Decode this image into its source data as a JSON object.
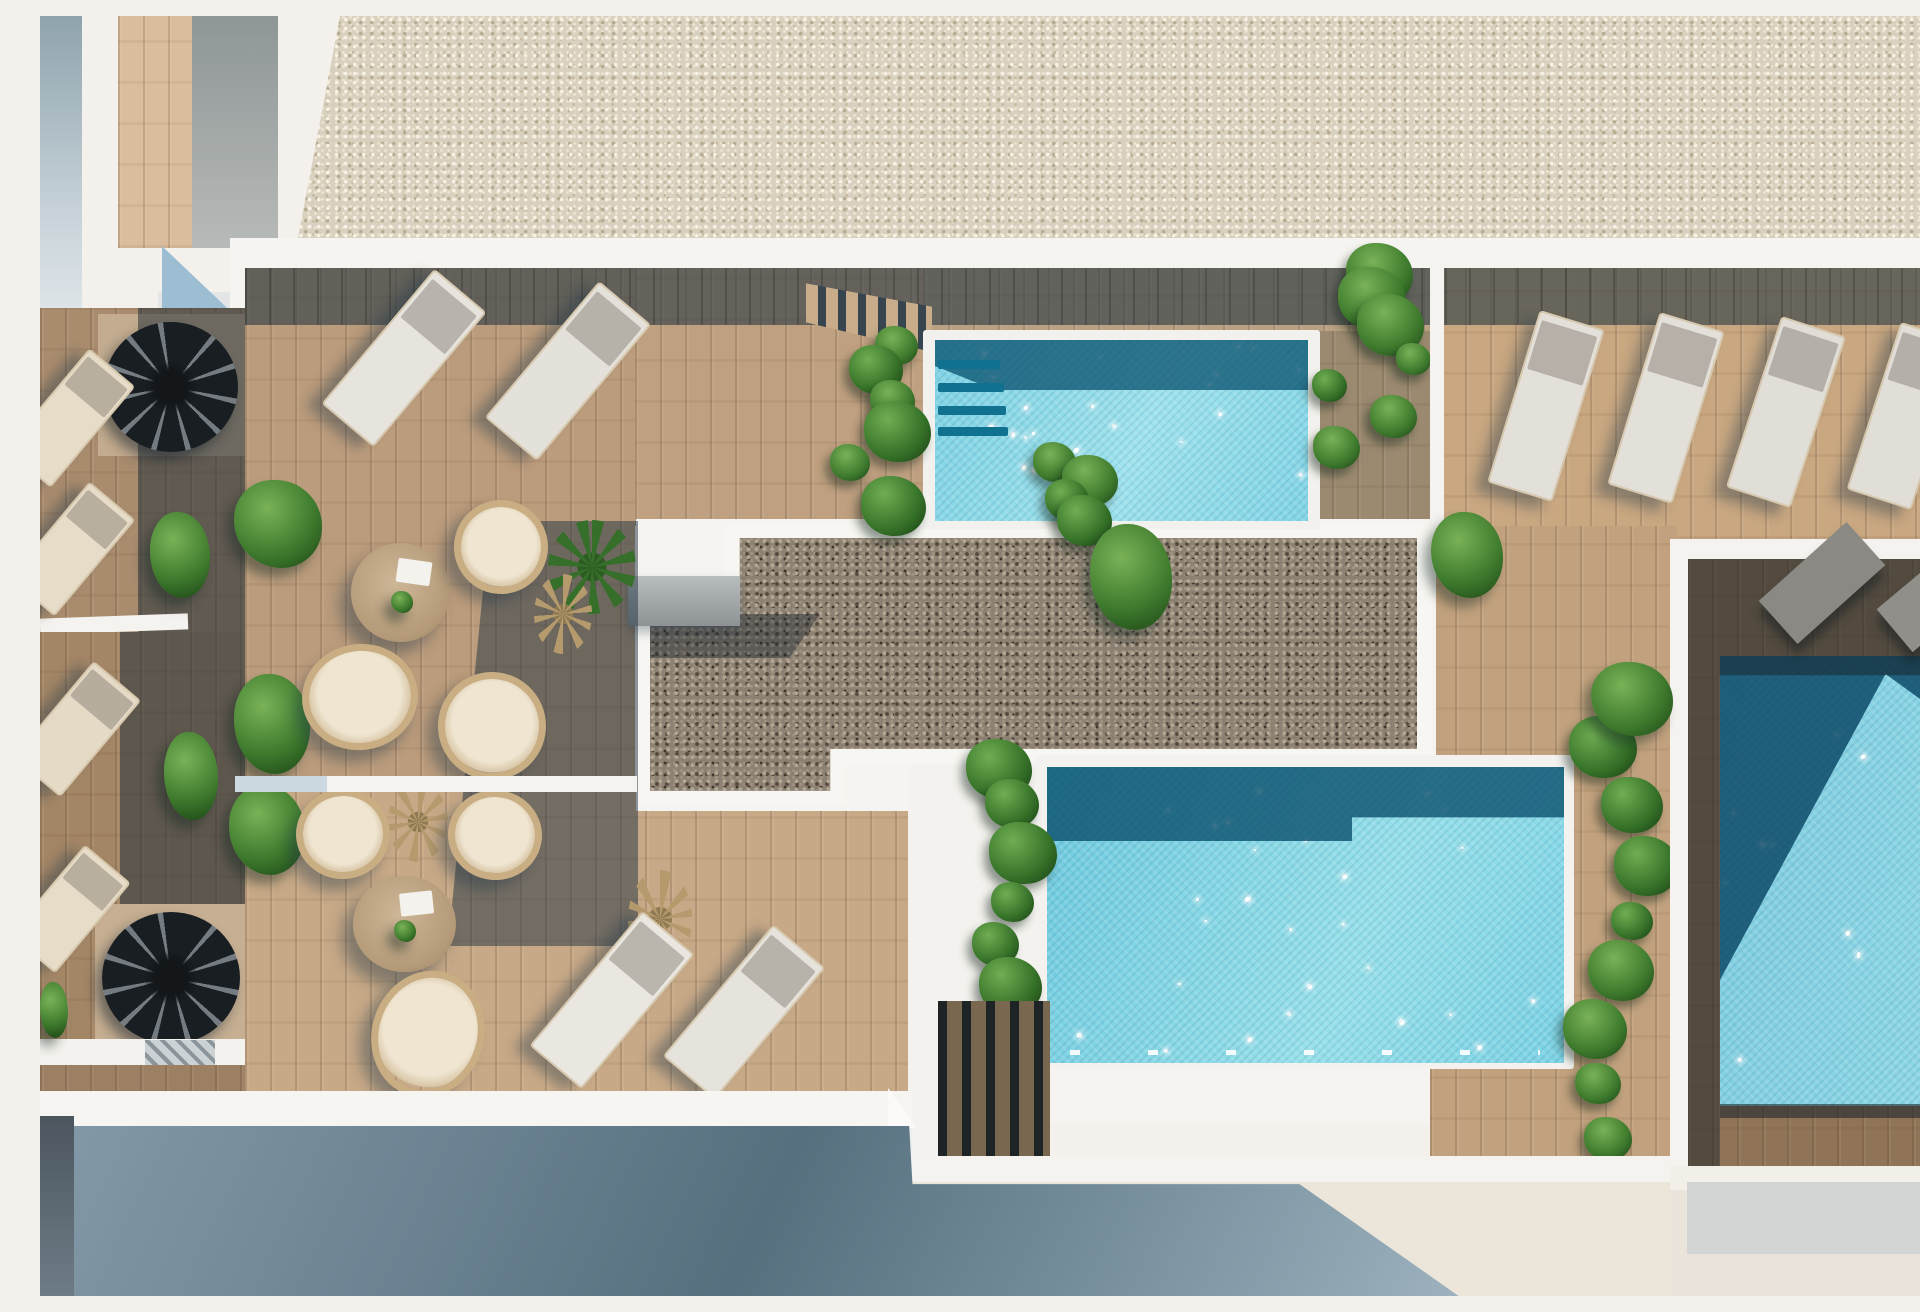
{
  "meta": {
    "scene": "top-down architectural 3D render of a rooftop terrace with three swimming pools, wooden decks, sun loungers, rattan seating and planters",
    "width": 1920,
    "height": 1280
  },
  "palette": {
    "white_wall": "#f5f3ef",
    "roof_gravel": "#d9d1c0",
    "deck_wood": "#c0a07e",
    "deck_shadow": "#41525f",
    "pool_aqua": "#8fd9e8",
    "pool_dark": "#135e82",
    "bed_gravel": "#8c8173",
    "plant_green": "#3e7a2d",
    "ground_shadow": "#5c7583"
  },
  "items": [
    {
      "n": "sky-white-base",
      "x": 0,
      "y": 0,
      "w": 1920,
      "h": 1280,
      "c": "#f4f1ec"
    },
    {
      "n": "roof-gravel-strip",
      "cls": "gravelA",
      "x": 258,
      "y": 0,
      "w": 1635,
      "h": 222,
      "cp": "polygon(42px 0,100% 0,100% 100%,0 100%)"
    },
    {
      "n": "building-strip-left",
      "x": 0,
      "y": 0,
      "w": 42,
      "h": 292,
      "bg": "linear-gradient(180deg,#8fa3ae,#c9d4da 70%,#dde4e8)"
    },
    {
      "n": "wood-panel-topleft",
      "cls": "wood",
      "x": 78,
      "y": 0,
      "w": 74,
      "h": 232,
      "c": "#d9bd9d"
    },
    {
      "n": "gray-panel-topleft",
      "x": 152,
      "y": 0,
      "w": 86,
      "h": 232,
      "bg": "linear-gradient(180deg,#8e9696,#b7bab8)"
    },
    {
      "n": "white-slab-topleft",
      "x": 118,
      "y": 276,
      "w": 88,
      "h": 34,
      "c": "#e3e5e6"
    },
    {
      "n": "shadow-triangle-topleft",
      "x": 122,
      "y": 230,
      "w": 84,
      "h": 80,
      "c": "#9dbdd3",
      "cp": "polygon(0 0,100% 100%,0 100%)"
    },
    {
      "n": "platform-white-base",
      "x": 190,
      "y": 222,
      "w": 1730,
      "h": 886,
      "c": "#f6f4f0"
    },
    {
      "n": "left-terrace-floor-upper",
      "cls": "wood",
      "x": 0,
      "y": 292,
      "w": 205,
      "h": 330,
      "c": "#a98c6e"
    },
    {
      "n": "spiral-stair-floor-upper",
      "x": 58,
      "y": 298,
      "w": 148,
      "h": 142,
      "c": "#c3ac8f"
    },
    {
      "n": "left-terrace-shadow-upper",
      "x": 98,
      "y": 292,
      "w": 107,
      "h": 330,
      "c": "rgba(26,40,52,.5)"
    },
    {
      "n": "spiral-staircase-upper",
      "cls": "spiral",
      "x": 64,
      "y": 306,
      "w": 134,
      "h": 130
    },
    {
      "n": "left-wall-band-mid",
      "x": 0,
      "y": 600,
      "w": 148,
      "h": 16,
      "c": "#f5f3ef",
      "tr": "rotate(-2deg)"
    },
    {
      "n": "left-terrace-floor-lower",
      "cls": "wood",
      "x": 0,
      "y": 616,
      "w": 205,
      "h": 410,
      "c": "#a38666"
    },
    {
      "n": "left-terrace-shadow-lower",
      "x": 80,
      "y": 616,
      "w": 125,
      "h": 410,
      "c": "rgba(26,40,52,.5)"
    },
    {
      "n": "spiral-stair-floor-lower",
      "x": 55,
      "y": 888,
      "w": 150,
      "h": 140,
      "c": "#c6af92"
    },
    {
      "n": "spiral-staircase-lower",
      "cls": "spiral",
      "x": 62,
      "y": 896,
      "w": 138,
      "h": 132
    },
    {
      "n": "left-wall-band-lower",
      "x": 0,
      "y": 1023,
      "w": 205,
      "h": 26,
      "c": "#f4f2ee"
    },
    {
      "n": "hatched-slab",
      "cls": "slabH",
      "x": 105,
      "y": 1024,
      "w": 70,
      "h": 27
    },
    {
      "n": "left-terrace-floor-bottom",
      "cls": "wood",
      "x": 0,
      "y": 1049,
      "w": 205,
      "h": 28,
      "c": "#9c8063"
    },
    {
      "n": "grass-patch-left",
      "cls": "bush",
      "x": 0,
      "y": 966,
      "w": 28,
      "h": 56
    },
    {
      "n": "lounger-left-1",
      "cls": "lounger",
      "x": 0,
      "y": 336,
      "w": 56,
      "h": 128,
      "c": "#e7dcc8",
      "tr": "rotate(40deg)"
    },
    {
      "n": "lounger-left-2",
      "cls": "lounger",
      "x": 2,
      "y": 470,
      "w": 56,
      "h": 122,
      "c": "#e7dcc8",
      "tr": "rotate(40deg)"
    },
    {
      "n": "lounger-left-3",
      "cls": "lounger",
      "x": 6,
      "y": 650,
      "w": 58,
      "h": 122,
      "c": "#e5dac6",
      "tr": "rotate(40deg)"
    },
    {
      "n": "lounger-left-4",
      "cls": "lounger",
      "x": 0,
      "y": 834,
      "w": 56,
      "h": 114,
      "c": "#e7dcc8",
      "tr": "rotate(40deg)"
    },
    {
      "n": "bush-left-terrace-1",
      "cls": "bush",
      "x": 110,
      "y": 496,
      "w": 60,
      "h": 86
    },
    {
      "n": "bush-left-terrace-2",
      "cls": "bush",
      "x": 124,
      "y": 716,
      "w": 54,
      "h": 88
    },
    {
      "n": "side-table-left-edge",
      "x": 0,
      "y": 1082,
      "w": 26,
      "h": 26,
      "c": "#d8d8d6",
      "br": "50%"
    },
    {
      "n": "deck-left-upper",
      "cls": "wood",
      "x": 205,
      "y": 252,
      "w": 390,
      "h": 523,
      "c": "#bb9c7c"
    },
    {
      "n": "deck-left-lower",
      "cls": "wood",
      "x": 205,
      "y": 775,
      "w": 665,
      "h": 315,
      "c": "#c7a987"
    },
    {
      "n": "deck-top-middle",
      "cls": "wood",
      "x": 595,
      "y": 252,
      "w": 295,
      "h": 258,
      "c": "#bfa080"
    },
    {
      "n": "deck-pool1-top",
      "cls": "wood",
      "x": 883,
      "y": 252,
      "w": 517,
      "h": 70,
      "c": "#b9a183"
    },
    {
      "n": "deck-pool1-right",
      "cls": "wood",
      "x": 1267,
      "y": 315,
      "w": 133,
      "h": 198,
      "c": "#9b8a70"
    },
    {
      "n": "deck-right-upper",
      "cls": "wood",
      "x": 1400,
      "y": 252,
      "w": 520,
      "h": 271,
      "c": "#c8a781"
    },
    {
      "n": "deck-mid-right",
      "cls": "wood",
      "x": 1390,
      "y": 510,
      "w": 247,
      "h": 635,
      "c": "#c2a27e"
    },
    {
      "n": "deck-pool3-surround",
      "cls": "wood",
      "x": 1647,
      "y": 543,
      "w": 273,
      "h": 612,
      "c": "#8f7457"
    },
    {
      "n": "top-shadow-band",
      "cls": "bandlines",
      "x": 205,
      "y": 252,
      "w": 1715,
      "h": 57,
      "c": "rgba(40,56,67,.6)"
    },
    {
      "n": "stair-treads-top",
      "cls": "treads",
      "x": 766,
      "y": 258,
      "w": 126,
      "h": 78,
      "cp": "polygon(0 12%,100% 42%,100% 100%,0 62%)"
    },
    {
      "n": "stair-shadow-wedge",
      "x": 766,
      "y": 300,
      "w": 132,
      "h": 88,
      "c": "rgba(30,45,56,.55),",
      "cp": "polygon(0 18%,100% 2%,52% 100%,0 100%)"
    },
    {
      "n": "plaza-white",
      "x": 596,
      "y": 503,
      "w": 800,
      "h": 292,
      "c": "#f6f4f0"
    },
    {
      "n": "plaza-white-south",
      "x": 868,
      "y": 740,
      "w": 142,
      "h": 412,
      "c": "#f4f2ee"
    },
    {
      "n": "gravel-bed-border",
      "x": 596,
      "y": 508,
      "w": 800,
      "h": 286,
      "c": "#f7f6f2",
      "cp": "polygon(0 30%,11.3% 30%,11.3% 0,99.5% 0,99.5% 84%,26.3% 84%,26.3% 98.6%,0 98.6%)"
    },
    {
      "n": "gravel-bed",
      "cls": "gravelB",
      "x": 610,
      "y": 522,
      "w": 767,
      "h": 258,
      "cp": "polygon(0 33.3%,11.7% 33.3%,11.7% 0,100% 0,100% 81.8%,23.5% 81.8%,23.5% 98%,0 98%)"
    },
    {
      "n": "gravel-shadow-edge",
      "x": 610,
      "y": 598,
      "w": 170,
      "h": 44,
      "c": "rgba(22,32,42,.4)",
      "cp": "polygon(0 0,100% 0,82% 100%,0 100%)"
    },
    {
      "n": "concrete-slab",
      "x": 588,
      "y": 560,
      "w": 112,
      "h": 50,
      "bg": "linear-gradient(180deg,#b9bdbe,#8d9395)",
      "bs": "0 6px 10px rgba(40,60,75,.35)"
    },
    {
      "n": "pool1-coping",
      "x": 883,
      "y": 314,
      "w": 397,
      "h": 199,
      "c": "#f2f1ed",
      "br": "3px"
    },
    {
      "n": "pool1-water",
      "cls": "water",
      "x": 895,
      "y": 324,
      "w": 373,
      "h": 181,
      "bg": "linear-gradient(115deg,#7ed2e4,#9ee2ec 55%,#83d5e6)",
      "sp": 22
    },
    {
      "n": "pool1-shadow-water",
      "x": 895,
      "y": 324,
      "w": 373,
      "h": 50,
      "c": "rgba(12,84,114,.78)",
      "cp": "polygon(0 0,100% 0,100% 100%,16% 100%,0 52%)"
    },
    {
      "n": "pool1-step-1",
      "x": 898,
      "y": 344,
      "w": 62,
      "h": 9,
      "c": "#117190",
      "br": "2px"
    },
    {
      "n": "pool1-step-2",
      "x": 898,
      "y": 367,
      "w": 66,
      "h": 9,
      "c": "#117190",
      "br": "2px"
    },
    {
      "n": "pool1-step-3",
      "x": 898,
      "y": 390,
      "w": 68,
      "h": 9,
      "c": "#117190",
      "br": "2px"
    },
    {
      "n": "pool1-step-4",
      "x": 898,
      "y": 411,
      "w": 70,
      "h": 9,
      "c": "#117190",
      "br": "2px"
    },
    {
      "n": "planter-pool1-left",
      "cls": "leafcol",
      "x": 790,
      "y": 316,
      "w": 96,
      "h": 192,
      "k": 6
    },
    {
      "n": "planter-pool1-right",
      "cls": "leafcol",
      "x": 1266,
      "y": 248,
      "w": 124,
      "h": 210,
      "k": 7
    },
    {
      "n": "white-wall-pool1-right",
      "x": 1390,
      "y": 248,
      "w": 14,
      "h": 264,
      "c": "#f5f3ef"
    },
    {
      "n": "plant-cluster-mid",
      "cls": "leafcol",
      "x": 980,
      "y": 450,
      "w": 108,
      "h": 64,
      "k": 4
    },
    {
      "n": "bush-gravel-corner",
      "cls": "bush",
      "x": 1050,
      "y": 508,
      "w": 82,
      "h": 106
    },
    {
      "n": "pool2-coping",
      "x": 995,
      "y": 739,
      "w": 539,
      "h": 314,
      "c": "#f3f2ee",
      "br": "3px"
    },
    {
      "n": "pool2-water",
      "cls": "water",
      "x": 1007,
      "y": 751,
      "w": 517,
      "h": 296,
      "bg": "linear-gradient(115deg,#6ecadf,#97e0ea 60%,#7dd3e5)",
      "sp": 26
    },
    {
      "n": "pool2-shadow-water",
      "x": 1007,
      "y": 751,
      "w": 517,
      "h": 74,
      "c": "rgba(10,80,110,.8)",
      "cp": "polygon(0 0,100% 0,100% 68%,59% 68%,59% 100%,0 100%)"
    },
    {
      "n": "pool2-lane-dashes",
      "x": 1030,
      "y": 1034,
      "w": 470,
      "h": 5,
      "bg": "repeating-linear-gradient(90deg,rgba(255,255,255,.9) 0 10px,transparent 10px 78px)"
    },
    {
      "n": "planter-pool2-left",
      "cls": "leafcol",
      "x": 932,
      "y": 736,
      "w": 80,
      "h": 272,
      "k": 6
    },
    {
      "n": "deck-steps-block",
      "cls": "stepsV",
      "x": 898,
      "y": 985,
      "w": 112,
      "h": 158
    },
    {
      "n": "planter-pool2-right",
      "cls": "leafcol",
      "x": 1520,
      "y": 718,
      "w": 116,
      "h": 446,
      "k": 8
    },
    {
      "n": "pool3-water",
      "cls": "water",
      "x": 1680,
      "y": 640,
      "w": 240,
      "h": 450,
      "bg": "linear-gradient(100deg,#7fcde0,#8fd8e6)",
      "sp": 14
    },
    {
      "n": "pool3-shadow-water",
      "x": 1680,
      "y": 640,
      "w": 240,
      "h": 450,
      "c": "rgba(9,70,100,.82)",
      "cp": "polygon(0 0,100% 0,100% 16%,69% 4%,0 72%)"
    },
    {
      "n": "pool3-groove",
      "x": 1680,
      "y": 1088,
      "w": 240,
      "h": 14,
      "c": "rgba(30,38,44,.6)"
    },
    {
      "n": "pool3-deck-shadow",
      "x": 1647,
      "y": 543,
      "w": 273,
      "h": 612,
      "c": "rgba(24,33,40,.5)",
      "cp": "polygon(0 0,100% 0,100% 19%,12% 19%,12% 100%,0 100%)"
    },
    {
      "n": "white-wall-pool3-left",
      "x": 1630,
      "y": 523,
      "w": 18,
      "h": 640,
      "c": "#f5f3ef"
    },
    {
      "n": "white-wall-pool3-top",
      "x": 1630,
      "y": 523,
      "w": 290,
      "h": 20,
      "c": "#f5f3ef"
    },
    {
      "n": "gray-lounger-1",
      "x": 1723,
      "y": 538,
      "w": 118,
      "h": 58,
      "c": "#8b8984",
      "tr": "rotate(-42deg)",
      "bs": "-8px 8px 10px rgba(20,28,34,.5)"
    },
    {
      "n": "gray-lounger-2",
      "x": 1842,
      "y": 552,
      "w": 108,
      "h": 56,
      "c": "#918f8a",
      "tr": "rotate(-40deg)",
      "bs": "-8px 8px 10px rgba(20,28,34,.5)"
    },
    {
      "n": "bush-right-deck-1",
      "cls": "bush",
      "x": 1391,
      "y": 496,
      "w": 72,
      "h": 86
    },
    {
      "n": "bush-right-deck-2",
      "cls": "bush",
      "x": 1551,
      "y": 646,
      "w": 82,
      "h": 74
    },
    {
      "n": "deck-shadow-diagonal",
      "x": 408,
      "y": 505,
      "w": 190,
      "h": 425,
      "c": "rgba(31,50,64,.5)",
      "cp": "polygon(22% 0,100% 0,100% 100%,0 100%)"
    },
    {
      "n": "lounger-deck-1",
      "cls": "lounger",
      "x": 330,
      "y": 254,
      "w": 64,
      "h": 172,
      "c": "#e7e4de",
      "tr": "rotate(40deg)"
    },
    {
      "n": "lounger-deck-2",
      "cls": "lounger",
      "x": 494,
      "y": 266,
      "w": 64,
      "h": 174,
      "c": "#e4e1da",
      "tr": "rotate(40deg)"
    },
    {
      "n": "bush-terrace-1",
      "cls": "bush",
      "x": 194,
      "y": 464,
      "w": 88,
      "h": 88
    },
    {
      "n": "bush-terrace-2",
      "cls": "bush",
      "x": 194,
      "y": 658,
      "w": 76,
      "h": 100
    },
    {
      "n": "bush-terrace-3",
      "cls": "bush",
      "x": 189,
      "y": 769,
      "w": 76,
      "h": 90
    },
    {
      "n": "palm-yucca",
      "cls": "palmg",
      "x": 508,
      "y": 504,
      "w": 88,
      "h": 94
    },
    {
      "n": "dry-palm-1",
      "cls": "palmd",
      "x": 494,
      "y": 558,
      "w": 58,
      "h": 80
    },
    {
      "n": "dry-palm-2",
      "cls": "palmd",
      "x": 348,
      "y": 766,
      "w": 60,
      "h": 80
    },
    {
      "n": "dry-palm-3",
      "cls": "palmd",
      "x": 588,
      "y": 854,
      "w": 64,
      "h": 98
    },
    {
      "n": "round-table-upper",
      "cls": "tableR",
      "x": 311,
      "y": 527,
      "w": 99,
      "h": 99
    },
    {
      "n": "book-on-table-upper",
      "x": 357,
      "y": 544,
      "w": 34,
      "h": 24,
      "c": "#f4f2ec",
      "tr": "rotate(8deg)",
      "br": "2px"
    },
    {
      "n": "plant-pot-upper",
      "cls": "bush",
      "x": 351,
      "y": 575,
      "w": 22,
      "h": 22
    },
    {
      "n": "armchair-upper-east",
      "cls": "rattan",
      "x": 414,
      "y": 484,
      "w": 94,
      "h": 94,
      "tr": "rotate(14deg)"
    },
    {
      "n": "armchair-upper-sw",
      "cls": "rattan",
      "x": 262,
      "y": 628,
      "w": 116,
      "h": 106,
      "tr": "rotate(-8deg)"
    },
    {
      "n": "armchair-upper-se",
      "cls": "rattan",
      "x": 398,
      "y": 656,
      "w": 108,
      "h": 108,
      "tr": "rotate(10deg)"
    },
    {
      "n": "armchair-lower-nw",
      "cls": "rattan",
      "x": 256,
      "y": 773,
      "w": 94,
      "h": 90,
      "tr": "rotate(-4deg)"
    },
    {
      "n": "armchair-lower-ne",
      "cls": "rattan",
      "x": 408,
      "y": 774,
      "w": 94,
      "h": 90,
      "tr": "rotate(6deg)"
    },
    {
      "n": "round-table-lower",
      "cls": "tableR",
      "x": 313,
      "y": 860,
      "w": 103,
      "h": 96
    },
    {
      "n": "book-on-table-lower",
      "x": 360,
      "y": 876,
      "w": 33,
      "h": 23,
      "c": "#f4f2ec",
      "tr": "rotate(-6deg)",
      "br": "2px"
    },
    {
      "n": "plant-pot-lower",
      "cls": "bush",
      "x": 354,
      "y": 904,
      "w": 22,
      "h": 22
    },
    {
      "n": "armchair-lower-south",
      "cls": "rattan",
      "x": 332,
      "y": 954,
      "w": 112,
      "h": 128,
      "tr": "rotate(18deg)"
    },
    {
      "n": "lounger-bottom-1",
      "cls": "lounger",
      "x": 538,
      "y": 896,
      "w": 64,
      "h": 172,
      "c": "#eae7e1",
      "tr": "rotate(40deg)"
    },
    {
      "n": "lounger-bottom-2",
      "cls": "lounger",
      "x": 670,
      "y": 910,
      "w": 64,
      "h": 168,
      "c": "#e6e3dc",
      "tr": "rotate(40deg)"
    },
    {
      "n": "lounger-row-1",
      "cls": "lounger",
      "x": 1472,
      "y": 300,
      "w": 64,
      "h": 176,
      "c": "#e3dfd9",
      "tr": "rotate(17deg)"
    },
    {
      "n": "lounger-row-2",
      "cls": "lounger",
      "x": 1592,
      "y": 302,
      "w": 64,
      "h": 176,
      "c": "#e3dfd9",
      "tr": "rotate(17deg)"
    },
    {
      "n": "lounger-row-3",
      "cls": "lounger",
      "x": 1712,
      "y": 306,
      "w": 64,
      "h": 176,
      "c": "#e1ddd7",
      "tr": "rotate(18deg)"
    },
    {
      "n": "lounger-row-4",
      "cls": "lounger",
      "x": 1832,
      "y": 312,
      "w": 64,
      "h": 172,
      "c": "#e1ddd7",
      "tr": "rotate(18deg)"
    },
    {
      "n": "wall-band-terrace-divider",
      "x": 195,
      "y": 760,
      "w": 402,
      "h": 16,
      "c": "#f5f3ef"
    },
    {
      "n": "wall-band-divider-shaded",
      "x": 195,
      "y": 760,
      "w": 92,
      "h": 16,
      "c": "#cdd9e1"
    },
    {
      "n": "ground-left",
      "x": 0,
      "y": 1108,
      "w": 872,
      "h": 172,
      "c": "#eef0ef"
    },
    {
      "n": "ground-mid",
      "x": 870,
      "y": 1164,
      "w": 760,
      "h": 116,
      "c": "#ebe5da"
    },
    {
      "n": "ground-right",
      "x": 1630,
      "y": 1172,
      "w": 290,
      "h": 108,
      "c": "#eae4da"
    },
    {
      "n": "wall-band-bottom-left",
      "x": 0,
      "y": 1075,
      "w": 872,
      "h": 36,
      "c": "#f7f5f1"
    },
    {
      "n": "wall-band-bottom-mid",
      "x": 870,
      "y": 1140,
      "w": 762,
      "h": 26,
      "c": "#f5f3ef"
    },
    {
      "n": "wall-band-bottom-right",
      "x": 1630,
      "y": 1150,
      "w": 290,
      "h": 24,
      "c": "#f2efe9"
    },
    {
      "n": "white-notch-triangle",
      "x": 848,
      "y": 1072,
      "w": 28,
      "h": 40,
      "c": "#fbfaf8",
      "cp": "polygon(0 0,100% 100%,0 100%)"
    },
    {
      "n": "ground-shadow-main",
      "x": 0,
      "y": 1085,
      "w": 1640,
      "h": 195,
      "bg": "linear-gradient(115deg,#859aa9,#56707f 45%,#8ba2af 78%,#b6c8d1)",
      "cp": "polygon(0 12.8%,53% 12.8%,53.2% 42.6%,76.8% 42.6%,86.5% 100%,0 100%)"
    },
    {
      "n": "ground-shadow-left-strip",
      "x": 0,
      "y": 1100,
      "w": 34,
      "h": 180,
      "bg": "linear-gradient(180deg,#4b555e,#6e7c87)"
    },
    {
      "n": "ground-gray-band-right",
      "x": 1647,
      "y": 1166,
      "w": 273,
      "h": 72,
      "c": "#d3d5d4"
    }
  ]
}
